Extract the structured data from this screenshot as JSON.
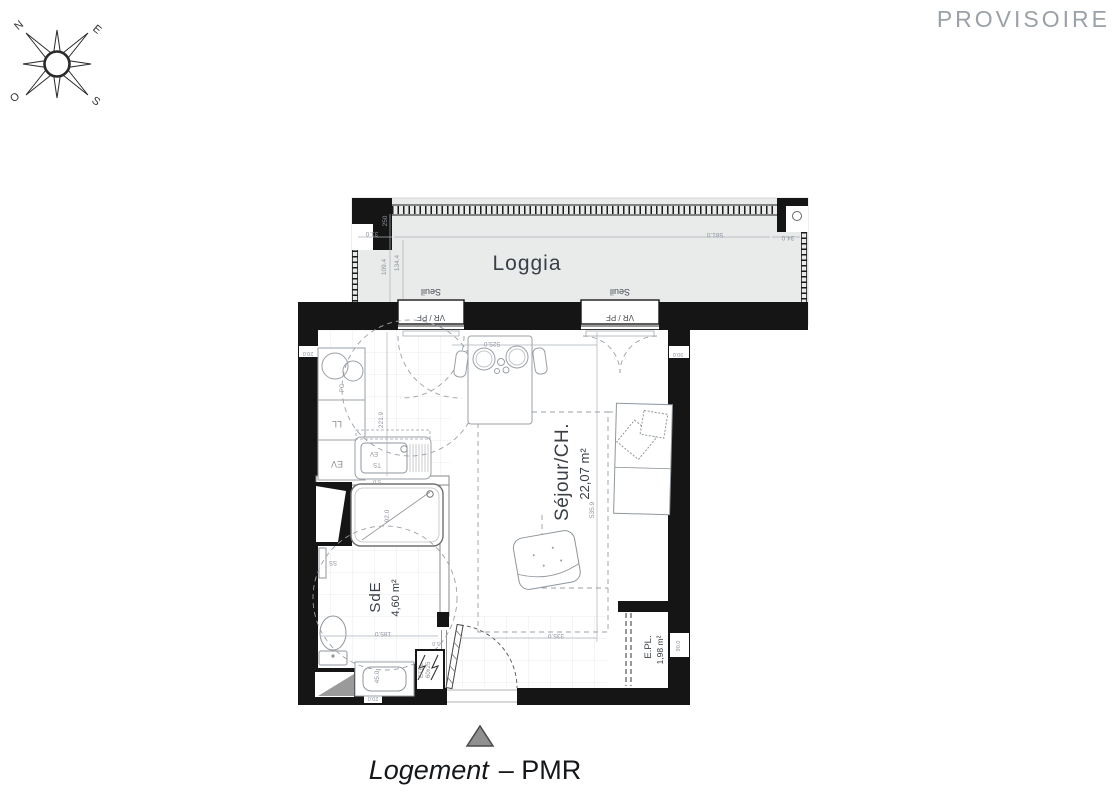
{
  "watermark": "PROVISOIRE",
  "compass": {
    "n": "N",
    "e": "E",
    "s": "S",
    "o": "O"
  },
  "title": {
    "name": "Logement",
    "type": "– PMR"
  },
  "rooms": {
    "loggia": {
      "label": "Loggia"
    },
    "sejour": {
      "label": "Séjour/CH.",
      "area": "22,07 m²"
    },
    "sde": {
      "label": "SdE",
      "area": "4,60 m²"
    },
    "epl": {
      "label": "E.PL.",
      "area": "1,98 m²"
    }
  },
  "openings": {
    "window_label": "VR / PF",
    "threshold_label": "Seuil"
  },
  "equipment": {
    "washer": "LL",
    "cabinet": "EV",
    "cooktop": "PC",
    "sink": "EV",
    "sink2": "TS",
    "towel_rail": "SS",
    "elec_panel": "ETEL",
    "elec_panel_size": "60x25"
  },
  "dimensions": {
    "loggia_width": "581.0",
    "loggia_right": "34.0",
    "loggia_left": "31.0",
    "loggia_depth": "250",
    "loggia_d1": "109.4",
    "loggia_d2": "134.4",
    "table_span": "525.0",
    "kitchen_depth": "221.9",
    "sejour_depth": "535.9",
    "hall_width": "335.0",
    "sde_width": "185.0",
    "shower_width": "92.0",
    "basin_width": "45.0",
    "basin_depth": "20.0",
    "wall_left": "20.0",
    "wall_right_top": "90.0",
    "epl_width": "90.0",
    "jamb": "5.0",
    "shower_gap": "5.0"
  }
}
